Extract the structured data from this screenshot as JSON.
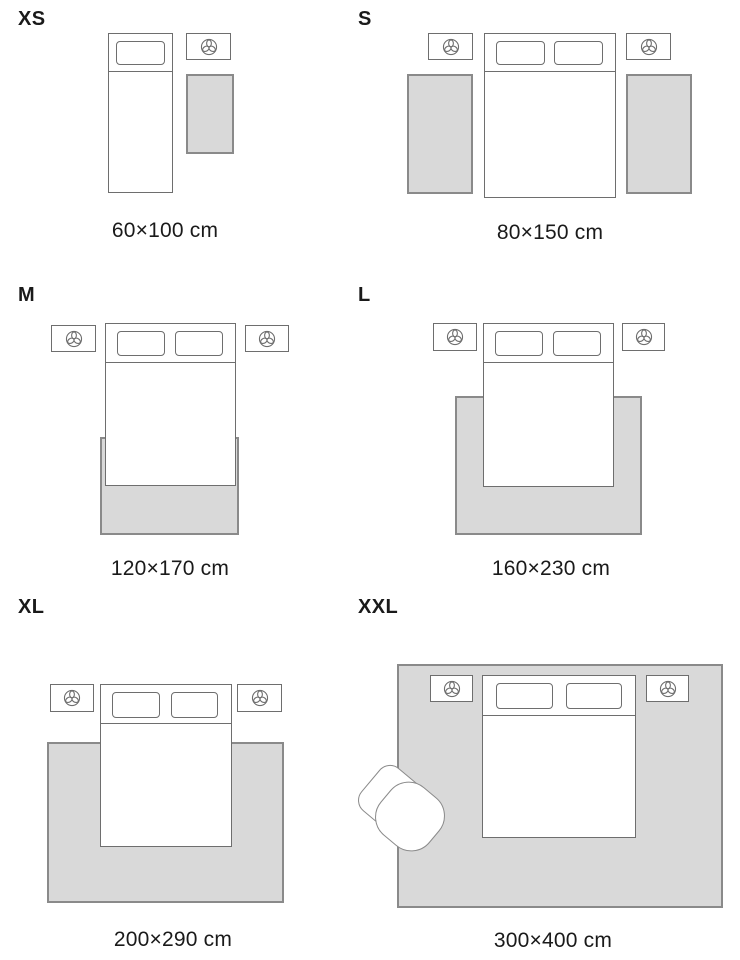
{
  "colors": {
    "outline": "#6e6e6e",
    "rug_fill": "#d9d9d9",
    "rug_border": "#8a8a8a",
    "text": "#1a1a1a",
    "bg": "#ffffff"
  },
  "icons": {
    "nightstand_icon": "plant-icon"
  },
  "panels": [
    {
      "size": "XS",
      "dimensions": "60×100 cm"
    },
    {
      "size": "S",
      "dimensions": "80×150 cm"
    },
    {
      "size": "M",
      "dimensions": "120×170 cm"
    },
    {
      "size": "L",
      "dimensions": "160×230 cm"
    },
    {
      "size": "XL",
      "dimensions": "200×290 cm"
    },
    {
      "size": "XXL",
      "dimensions": "300×400 cm"
    }
  ]
}
